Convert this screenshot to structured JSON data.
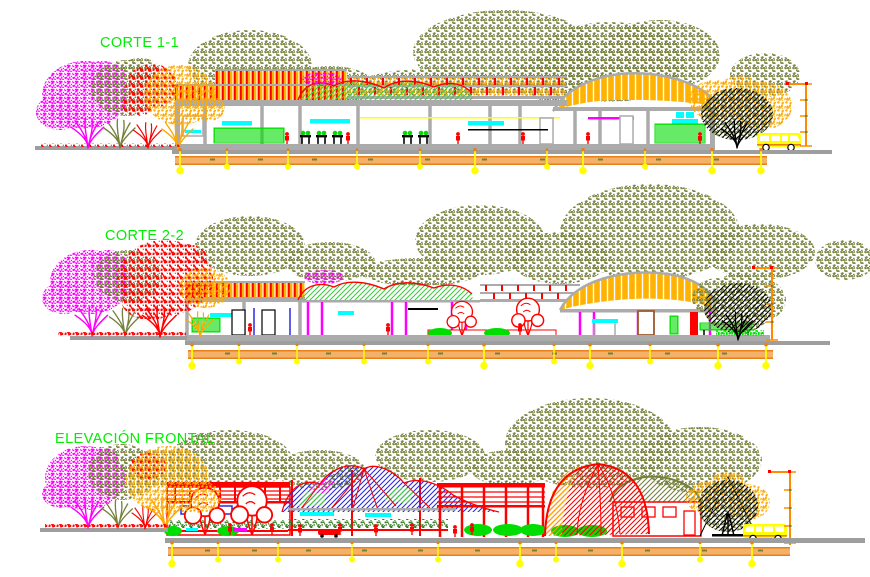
{
  "drawings": [
    {
      "id": "corte-1-1",
      "label": "CORTE 1-1"
    },
    {
      "id": "corte-2-2",
      "label": "CORTE 2-2"
    },
    {
      "id": "elevacion-frontal",
      "label": "ELEVACIÓN FRONTAL"
    }
  ],
  "colors": {
    "label": "#00EE00",
    "magenta": "#FF00FF",
    "red": "#FF0000",
    "orange": "#FFA800",
    "yellow": "#FFFF00",
    "olive": "#76803C",
    "green": "#00DD00",
    "darkgreen": "#2F7A1E",
    "canopy": "#3FCC3F",
    "blue": "#2A2AE0",
    "cyan": "#00FFFF",
    "slab": "#ABABAB",
    "ground": "#9E9E9E",
    "roof": "#FFB300",
    "band": "#F6B169",
    "band_edge": "#E6801A",
    "dim": "#FF8C00",
    "black": "#000000",
    "brown": "#9A5B2D"
  }
}
